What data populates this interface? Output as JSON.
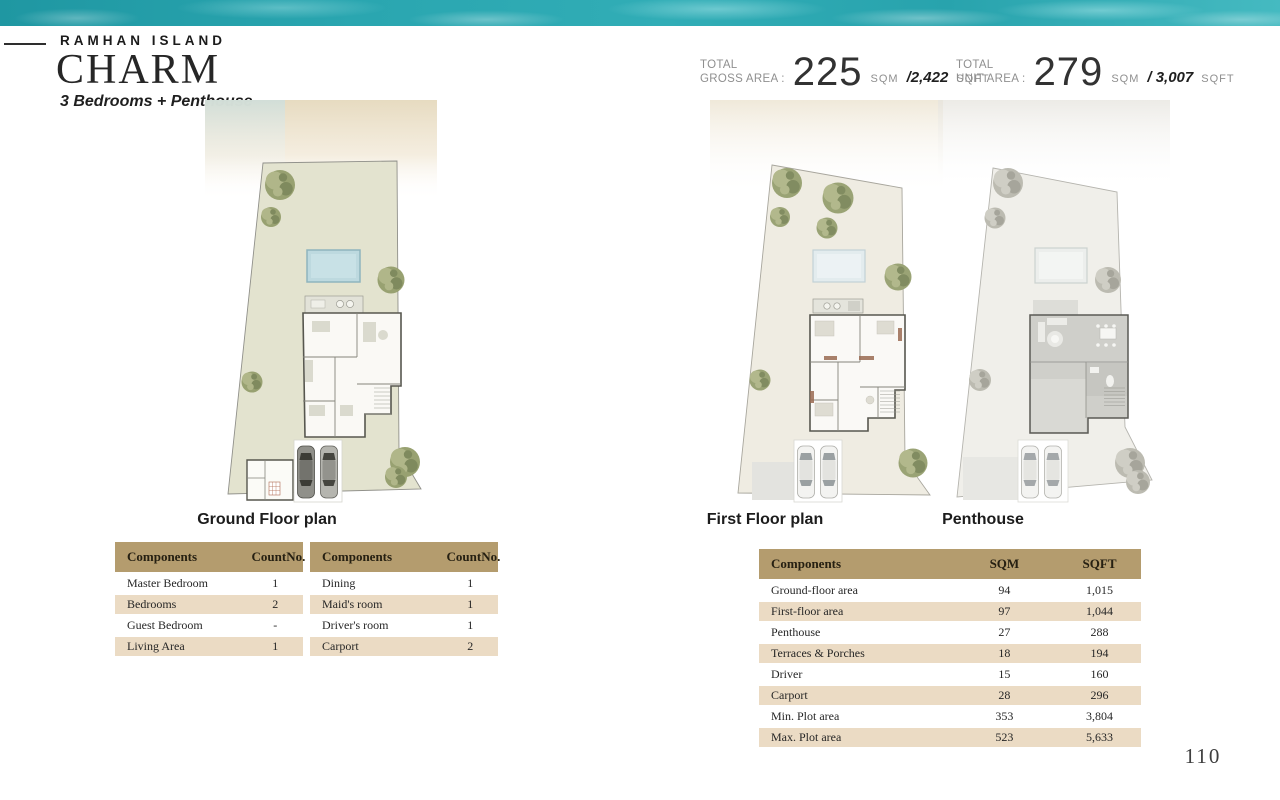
{
  "header": {
    "brand": "RAMHAN ISLAND",
    "title": "CHARM",
    "subtitle": "3 Bedrooms + Penthouse"
  },
  "stats": {
    "gross": {
      "label_line1": "TOTAL",
      "label_line2": "GROSS AREA :",
      "value": "225",
      "unit": "SQM",
      "alt_value": "/2,422",
      "alt_unit": "SQFT"
    },
    "unit": {
      "label_line1": "TOTAL",
      "label_line2": "UNIT AREA :",
      "value": "279",
      "unit": "SQM",
      "alt_value": "/ 3,007",
      "alt_unit": "SQFT"
    }
  },
  "plans": [
    {
      "label": "Ground Floor plan"
    },
    {
      "label": "First Floor plan"
    },
    {
      "label": "Penthouse"
    }
  ],
  "tables": {
    "count1": {
      "headers": [
        "Components",
        "CountNo."
      ],
      "rows": [
        [
          "Master Bedroom",
          "1"
        ],
        [
          "Bedrooms",
          "2"
        ],
        [
          "Guest Bedroom",
          "-"
        ],
        [
          "Living Area",
          "1"
        ]
      ]
    },
    "count2": {
      "headers": [
        "Components",
        "CountNo."
      ],
      "rows": [
        [
          "Dining",
          "1"
        ],
        [
          "Maid's room",
          "1"
        ],
        [
          "Driver's room",
          "1"
        ],
        [
          "Carport",
          "2"
        ]
      ]
    },
    "areas": {
      "headers": [
        "Components",
        "SQM",
        "SQFT"
      ],
      "rows": [
        [
          "Ground-floor area",
          "94",
          "1,015"
        ],
        [
          "First-floor area",
          "97",
          "1,044"
        ],
        [
          "Penthouse",
          "27",
          "288"
        ],
        [
          "Terraces & Porches",
          "18",
          "194"
        ],
        [
          "Driver",
          "15",
          "160"
        ],
        [
          "Carport",
          "28",
          "296"
        ],
        [
          "Min. Plot area",
          "353",
          "3,804"
        ],
        [
          "Max. Plot area",
          "523",
          "5,633"
        ]
      ]
    }
  },
  "page": {
    "number": "110"
  },
  "colors": {
    "accent_tan": "#b49c6e",
    "row_shade": "#ebdbc4",
    "water_teal": "#2aa6b0",
    "plot_green": "#e3e3cf",
    "plot_cream": "#efece2",
    "plot_gray": "#f0efeb",
    "pool_blue": "#bdd9df"
  }
}
